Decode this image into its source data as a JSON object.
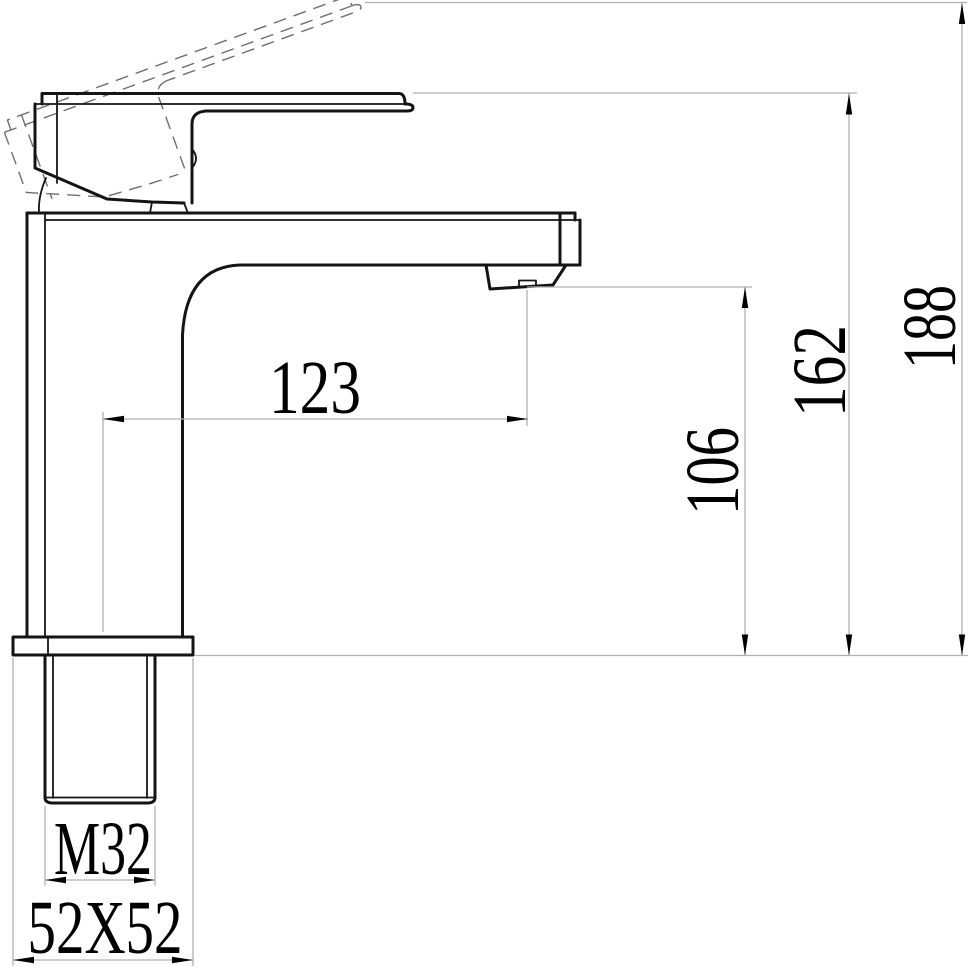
{
  "drawing": {
    "type": "technical-dimension-drawing",
    "subject": "single-lever basin faucet side elevation with raised-handle travel shown dashed",
    "background": "#ffffff",
    "outline_color": "#141414",
    "ghost_line_color": "#6e6e6e",
    "dim_line_color": "#b0b0b0",
    "text_color": "#000000",
    "dimensions": {
      "spout_reach": "123",
      "spout_outlet_height": "106",
      "handle_top_height": "162",
      "overall_height": "188",
      "thread_size": "M32",
      "base_section": "52X52"
    }
  }
}
